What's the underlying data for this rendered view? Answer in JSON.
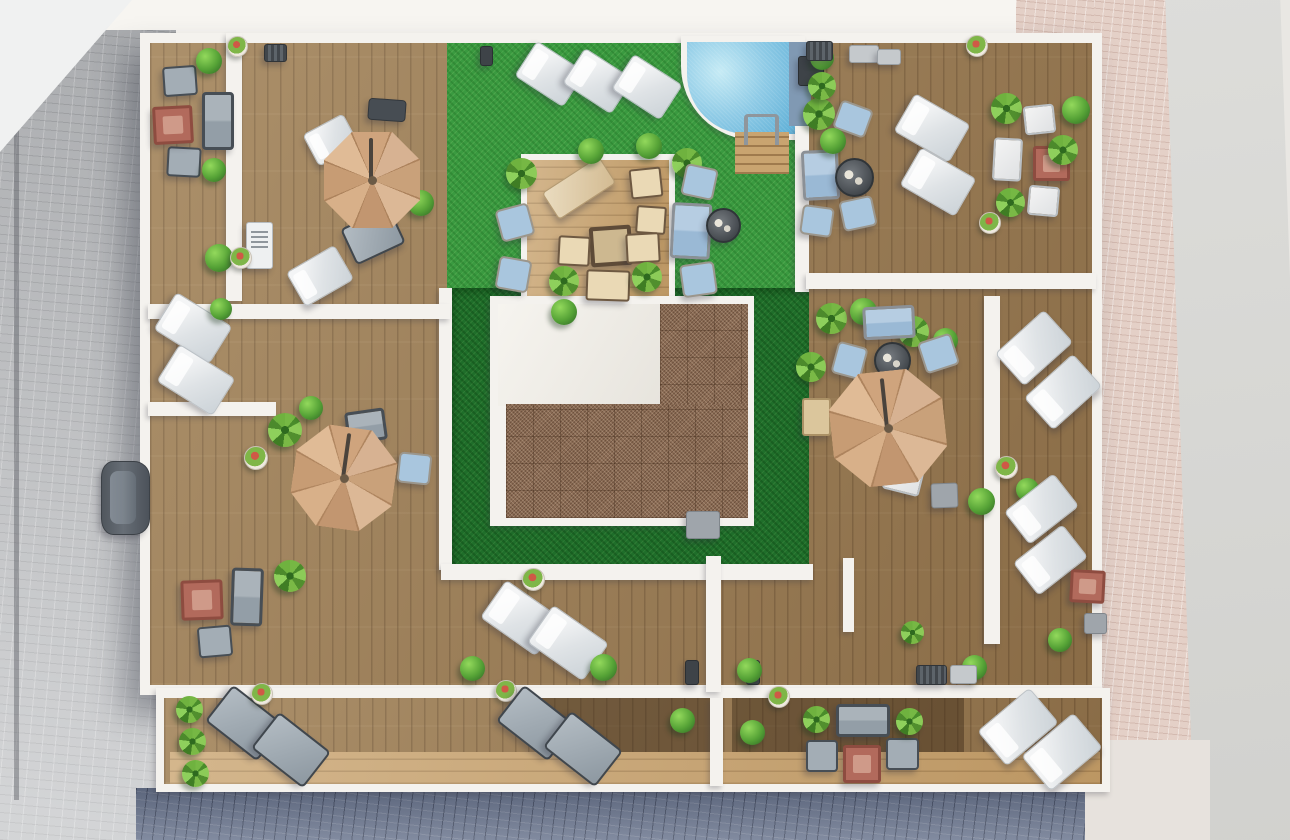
{
  "meta": {
    "description": "Photorealistic aerial 3D render of an apartment-building rooftop terrace plan: perimeter wooden sun decks divided by white parapet walls, central artificial-grass garden with a quarter-round swimming pool, timber pergola lounge platform, gravel-covered central core roof, three tan cantilever parasols, sun loungers, sofa sets and planting; surrounding streets with cobble paving and one parked car.",
    "width_px": 1290,
    "height_px": 840,
    "visible_text": []
  },
  "palette": {
    "deck_wood": "#9c7d54",
    "deck_light_wood": "#c9a470",
    "lawn_bright": "#3a9a40",
    "lawn_dark": "#1f6e2a",
    "gravel_roof": "#8b6c55",
    "pool_water": "#8fcbe6",
    "parasol_tan": "#cfa47d",
    "white_wall": "#f4f2ee",
    "street_grey": "#b4b6b9",
    "street_pink": "#e4d0c7",
    "street_blue_grey": "#6d7890",
    "road_light": "#d9d9d6"
  },
  "legend": {
    "lounger-w": "sun-lounger-white",
    "lounger-g": "sun-lounger-grey",
    "lounger-dark": "bench-dark",
    "lounger-beige": "sun-lounger-beige",
    "sofa-grey": "outdoor-sofa-grey",
    "sofa-blue": "outdoor-sofa-blue",
    "armchair-grey": "armchair-grey",
    "armchair-blue": "armchair-blue",
    "armchair-w": "armchair-white",
    "seat-white": "seat-white",
    "seat-beige": "seat-beige",
    "table-red": "coffee-table-terracotta",
    "table-beige": "side-table-beige",
    "table-round": "round-table-dark",
    "table-dark-beige": "dining-table-wood",
    "cube-grey": "utility-box-grey",
    "cube-dark": "planter-dark",
    "vent-dark": "ac-vent-dark",
    "vent-grey": "ac-unit-grey",
    "bbq": "outdoor-kitchen-grill",
    "pot": "flower-pot",
    "bush": "shrub-plant",
    "palm": "palm-plant",
    "umbrella": "parasol-umbrella",
    "car": "parked-car",
    "ladder": "pool-ladder"
  },
  "layer_fields": [
    "name",
    "class",
    "x",
    "y",
    "w",
    "h",
    "rotation_deg",
    "border_radius"
  ],
  "layers": [
    [
      "base-ground",
      "base",
      0,
      0,
      1290,
      840,
      0,
      ""
    ],
    [
      "sky-band-top",
      "band",
      0,
      0,
      1048,
      36,
      0,
      ""
    ],
    [
      "pink-paving-top",
      "pave-pink",
      1016,
      0,
      100,
      36,
      0,
      ""
    ],
    [
      "street-left",
      "pave-grey",
      0,
      30,
      176,
      810,
      0,
      ""
    ],
    [
      "street-left-curb",
      "curb",
      14,
      30,
      5,
      770,
      0,
      ""
    ],
    [
      "street-corner-top-left",
      "wedge",
      0,
      0,
      132,
      152,
      0,
      ""
    ],
    [
      "street-right-pink",
      "pave-pink",
      1094,
      0,
      106,
      818,
      0,
      ""
    ],
    [
      "road-right",
      "road",
      1180,
      -20,
      115,
      885,
      -2,
      ""
    ],
    [
      "street-bottom",
      "pave-blue",
      136,
      788,
      968,
      52,
      0,
      ""
    ],
    [
      "street-corner-bottom-right",
      "pave-light",
      1085,
      740,
      125,
      100,
      0,
      ""
    ],
    [
      "building-parapet",
      "bldg",
      140,
      33,
      962,
      662,
      0,
      ""
    ],
    [
      "main-deck",
      "deck-wood",
      150,
      43,
      942,
      642,
      0,
      ""
    ],
    [
      "lower-terrace-wall",
      "wall",
      156,
      688,
      954,
      104,
      0,
      ""
    ],
    [
      "lower-terrace-deck",
      "deck-wood",
      164,
      698,
      938,
      86,
      0,
      ""
    ],
    [
      "lower-terrace-light-band",
      "deck-light",
      170,
      752,
      930,
      32,
      0,
      ""
    ],
    [
      "lower-terrace-dark-a",
      "deck-dark",
      540,
      698,
      176,
      54,
      0,
      ""
    ],
    [
      "lower-terrace-dark-b",
      "deck-dark",
      732,
      698,
      232,
      54,
      0,
      ""
    ],
    [
      "lawn-bright",
      "lawn",
      447,
      43,
      360,
      248,
      0,
      ""
    ],
    [
      "lawn-dark-ring",
      "lawn-dark",
      451,
      288,
      358,
      280,
      0,
      ""
    ],
    [
      "wall-lawn-left",
      "wall",
      439,
      288,
      13,
      282,
      0,
      ""
    ],
    [
      "wall-lawn-bottom",
      "wall",
      441,
      564,
      372,
      16,
      0,
      ""
    ],
    [
      "pool-coping",
      "wall",
      681,
      36,
      124,
      104,
      0,
      "0 0 0 74px"
    ],
    [
      "pool-water",
      "pool",
      687,
      42,
      112,
      92,
      0,
      "0 0 0 60px"
    ],
    [
      "pool-side-deck",
      "pool-side",
      789,
      42,
      22,
      84,
      0,
      "0 0 6px 0"
    ],
    [
      "pool-steps",
      "steps",
      735,
      132,
      54,
      42,
      0,
      ""
    ],
    [
      "pergola-coping",
      "wall",
      521,
      154,
      154,
      152,
      0,
      ""
    ],
    [
      "pergola-deck",
      "deck-light",
      527,
      160,
      142,
      140,
      0,
      ""
    ],
    [
      "core-parapet",
      "wall",
      490,
      296,
      264,
      230,
      0,
      ""
    ],
    [
      "core-roof-white",
      "roof-white",
      498,
      304,
      162,
      102,
      0,
      ""
    ],
    [
      "core-gravel-upper",
      "gravel",
      660,
      304,
      88,
      108,
      0,
      ""
    ],
    [
      "core-gravel-lower",
      "gravel",
      506,
      404,
      242,
      114,
      0,
      ""
    ],
    [
      "divider-wall-1",
      "wall",
      226,
      33,
      16,
      268,
      0,
      ""
    ],
    [
      "divider-wall-2",
      "wall",
      148,
      304,
      302,
      15,
      0,
      ""
    ],
    [
      "divider-wall-3",
      "wall",
      148,
      402,
      128,
      14,
      0,
      ""
    ],
    [
      "divider-wall-4",
      "wall",
      795,
      126,
      14,
      166,
      0,
      ""
    ],
    [
      "divider-wall-5",
      "wall",
      806,
      273,
      290,
      16,
      0,
      ""
    ],
    [
      "divider-wall-6",
      "wall",
      984,
      296,
      16,
      348,
      0,
      ""
    ],
    [
      "divider-wall-7",
      "wall",
      706,
      556,
      15,
      136,
      0,
      ""
    ],
    [
      "divider-wall-8",
      "wall",
      710,
      698,
      13,
      88,
      0,
      ""
    ],
    [
      "divider-wall-9",
      "wall",
      843,
      558,
      11,
      74,
      0,
      ""
    ]
  ],
  "item_fields": [
    "type",
    "x",
    "y",
    "w",
    "h",
    "rotation_deg"
  ],
  "items": [
    [
      "armchair-grey",
      163,
      66,
      30,
      26,
      -4
    ],
    [
      "sofa-grey",
      202,
      92,
      26,
      52,
      0
    ],
    [
      "armchair-grey",
      167,
      147,
      30,
      26,
      3
    ],
    [
      "table-red",
      153,
      106,
      34,
      32,
      -3
    ],
    [
      "bush",
      196,
      48,
      26,
      26,
      0
    ],
    [
      "bush",
      202,
      158,
      24,
      24,
      0
    ],
    [
      "bush",
      205,
      244,
      28,
      28,
      0
    ],
    [
      "vent-dark",
      264,
      44,
      21,
      16,
      0
    ],
    [
      "bbq",
      246,
      222,
      25,
      45,
      0
    ],
    [
      "pot",
      227,
      36,
      19,
      19,
      0
    ],
    [
      "pot",
      230,
      247,
      20,
      20,
      0
    ],
    [
      "lounger-dark",
      368,
      99,
      36,
      20,
      4
    ],
    [
      "lounger-w",
      308,
      122,
      44,
      34,
      -28
    ],
    [
      "lounger-g",
      346,
      216,
      50,
      36,
      -25
    ],
    [
      "lounger-w",
      292,
      256,
      54,
      38,
      -30
    ],
    [
      "bush",
      408,
      190,
      26,
      26,
      0
    ],
    [
      "lounger-w",
      160,
      306,
      64,
      42,
      32
    ],
    [
      "lounger-w",
      163,
      358,
      64,
      42,
      32
    ],
    [
      "bush",
      210,
      298,
      22,
      22,
      0
    ],
    [
      "palm",
      268,
      413,
      34,
      34,
      0
    ],
    [
      "bush",
      299,
      396,
      24,
      24,
      0
    ],
    [
      "sofa-grey",
      346,
      410,
      34,
      26,
      -8
    ],
    [
      "armchair-blue",
      398,
      453,
      29,
      27,
      6
    ],
    [
      "pot",
      244,
      446,
      22,
      22,
      0
    ],
    [
      "palm",
      274,
      560,
      32,
      32,
      0
    ],
    [
      "table-red",
      181,
      580,
      36,
      34,
      -2
    ],
    [
      "sofa-grey",
      231,
      568,
      26,
      52,
      2
    ],
    [
      "armchair-grey",
      198,
      626,
      30,
      27,
      -5
    ],
    [
      "car",
      101,
      461,
      47,
      72,
      0
    ],
    [
      "palm",
      176,
      696,
      27,
      27,
      0
    ],
    [
      "palm",
      179,
      728,
      27,
      27,
      0
    ],
    [
      "palm",
      182,
      760,
      27,
      27,
      0
    ],
    [
      "lounger-g",
      212,
      700,
      62,
      42,
      38
    ],
    [
      "lounger-g",
      258,
      727,
      62,
      42,
      38
    ],
    [
      "pot",
      251,
      683,
      20,
      20,
      0
    ],
    [
      "pot",
      495,
      680,
      20,
      20,
      0
    ],
    [
      "lounger-g",
      503,
      700,
      62,
      42,
      38
    ],
    [
      "lounger-g",
      550,
      726,
      62,
      42,
      38
    ],
    [
      "bush",
      670,
      708,
      25,
      25,
      0
    ],
    [
      "bush",
      740,
      720,
      25,
      25,
      0
    ],
    [
      "pot",
      768,
      686,
      20,
      20,
      0
    ],
    [
      "sofa-grey",
      836,
      704,
      48,
      27,
      0
    ],
    [
      "armchair-grey",
      806,
      740,
      28,
      28,
      0
    ],
    [
      "armchair-grey",
      886,
      738,
      29,
      28,
      0
    ],
    [
      "table-red",
      843,
      745,
      32,
      32,
      0
    ],
    [
      "palm",
      803,
      706,
      27,
      27,
      0
    ],
    [
      "palm",
      896,
      708,
      27,
      27,
      0
    ],
    [
      "lounger-w",
      984,
      704,
      66,
      44,
      -40
    ],
    [
      "lounger-w",
      1028,
      729,
      66,
      44,
      -40
    ],
    [
      "lounger-w",
      487,
      595,
      66,
      44,
      35
    ],
    [
      "lounger-w",
      534,
      620,
      66,
      44,
      35
    ],
    [
      "bush",
      460,
      656,
      25,
      25,
      0
    ],
    [
      "bush",
      590,
      654,
      27,
      27,
      0
    ],
    [
      "pot",
      522,
      568,
      21,
      21,
      0
    ],
    [
      "cube-dark",
      685,
      660,
      12,
      23,
      0
    ],
    [
      "cube-dark",
      746,
      660,
      12,
      23,
      0
    ],
    [
      "bush",
      737,
      658,
      25,
      25,
      0
    ],
    [
      "palm",
      901,
      621,
      23,
      23,
      0
    ],
    [
      "bush",
      962,
      655,
      25,
      25,
      0
    ],
    [
      "vent-dark",
      916,
      665,
      29,
      18,
      0
    ],
    [
      "vent-grey",
      950,
      665,
      25,
      17,
      0
    ],
    [
      "bush",
      1048,
      628,
      24,
      24,
      0
    ],
    [
      "lounger-w",
      521,
      53,
      56,
      40,
      33
    ],
    [
      "lounger-w",
      569,
      60,
      56,
      40,
      33
    ],
    [
      "lounger-w",
      618,
      66,
      56,
      40,
      33
    ],
    [
      "cube-dark",
      480,
      46,
      11,
      18,
      0
    ],
    [
      "lounger-beige",
      545,
      172,
      66,
      30,
      -33
    ],
    [
      "seat-beige",
      630,
      168,
      28,
      26,
      -6
    ],
    [
      "seat-beige",
      636,
      206,
      26,
      24,
      4
    ],
    [
      "table-dark-beige",
      590,
      226,
      34,
      32,
      -4
    ],
    [
      "seat-beige",
      558,
      236,
      28,
      26,
      3
    ],
    [
      "seat-beige",
      626,
      233,
      30,
      26,
      -3
    ],
    [
      "seat-beige",
      586,
      270,
      40,
      27,
      2
    ],
    [
      "palm",
      549,
      266,
      30,
      30,
      0
    ],
    [
      "palm",
      632,
      262,
      30,
      30,
      0
    ],
    [
      "palm",
      506,
      158,
      31,
      31,
      0
    ],
    [
      "palm",
      672,
      148,
      30,
      30,
      0
    ],
    [
      "bush",
      578,
      138,
      26,
      26,
      0
    ],
    [
      "bush",
      636,
      133,
      26,
      26,
      0
    ],
    [
      "armchair-blue",
      498,
      206,
      30,
      29,
      -15
    ],
    [
      "armchair-blue",
      497,
      258,
      29,
      29,
      10
    ],
    [
      "armchair-blue",
      683,
      166,
      29,
      28,
      12
    ],
    [
      "sofa-blue",
      671,
      203,
      34,
      50,
      3
    ],
    [
      "armchair-blue",
      681,
      263,
      31,
      29,
      -8
    ],
    [
      "table-round",
      706,
      208,
      31,
      31,
      0
    ],
    [
      "bush",
      551,
      299,
      26,
      26,
      0
    ],
    [
      "ladder",
      744,
      114,
      27,
      28,
      0
    ],
    [
      "cube-dark",
      798,
      56,
      24,
      28,
      0
    ],
    [
      "armchair-blue",
      836,
      104,
      30,
      26,
      20
    ],
    [
      "sofa-blue",
      802,
      150,
      31,
      44,
      -3
    ],
    [
      "table-round",
      835,
      158,
      35,
      35,
      0
    ],
    [
      "armchair-blue",
      841,
      198,
      30,
      27,
      -12
    ],
    [
      "armchair-blue",
      801,
      206,
      28,
      26,
      8
    ],
    [
      "palm",
      803,
      98,
      32,
      32,
      0
    ],
    [
      "bush",
      820,
      128,
      26,
      26,
      0
    ],
    [
      "bush",
      810,
      46,
      24,
      24,
      0
    ],
    [
      "palm",
      808,
      72,
      28,
      28,
      0
    ],
    [
      "lounger-w",
      900,
      106,
      62,
      42,
      30
    ],
    [
      "lounger-w",
      906,
      160,
      62,
      42,
      30
    ],
    [
      "palm",
      991,
      93,
      31,
      31,
      0
    ],
    [
      "armchair-w",
      1024,
      105,
      27,
      25,
      -6
    ],
    [
      "seat-white",
      993,
      138,
      25,
      39,
      3
    ],
    [
      "table-red",
      1033,
      146,
      31,
      29,
      0
    ],
    [
      "armchair-w",
      1028,
      186,
      27,
      26,
      5
    ],
    [
      "palm",
      996,
      188,
      29,
      29,
      0
    ],
    [
      "pot",
      966,
      35,
      20,
      20,
      0
    ],
    [
      "pot",
      979,
      212,
      20,
      20,
      0
    ],
    [
      "vent-dark",
      806,
      41,
      25,
      18,
      0
    ],
    [
      "vent-grey",
      849,
      45,
      28,
      16,
      0
    ],
    [
      "vent-grey",
      877,
      49,
      22,
      14,
      0
    ],
    [
      "bush",
      1062,
      96,
      28,
      28,
      0
    ],
    [
      "palm",
      1048,
      135,
      30,
      30,
      0
    ],
    [
      "palm",
      816,
      303,
      31,
      31,
      0
    ],
    [
      "bush",
      850,
      298,
      27,
      27,
      0
    ],
    [
      "palm",
      898,
      316,
      31,
      31,
      0
    ],
    [
      "bush",
      933,
      328,
      25,
      25,
      0
    ],
    [
      "sofa-blue",
      863,
      306,
      46,
      27,
      -3
    ],
    [
      "table-round",
      874,
      342,
      33,
      33,
      0
    ],
    [
      "armchair-blue",
      834,
      344,
      27,
      29,
      15
    ],
    [
      "armchair-blue",
      921,
      337,
      31,
      29,
      -18
    ],
    [
      "seat-white",
      884,
      466,
      34,
      23,
      14
    ],
    [
      "cube-grey",
      931,
      483,
      25,
      23,
      -2
    ],
    [
      "table-beige",
      802,
      398,
      25,
      34,
      0
    ],
    [
      "palm",
      796,
      352,
      30,
      30,
      0
    ],
    [
      "bush",
      968,
      488,
      27,
      27,
      0
    ],
    [
      "bush",
      1016,
      478,
      23,
      23,
      0
    ],
    [
      "pot",
      995,
      456,
      21,
      21,
      0
    ],
    [
      "lounger-w",
      1001,
      326,
      64,
      42,
      -42
    ],
    [
      "lounger-w",
      1030,
      370,
      64,
      42,
      -42
    ],
    [
      "lounger-w",
      1010,
      488,
      61,
      40,
      -38
    ],
    [
      "lounger-w",
      1019,
      539,
      61,
      40,
      -38
    ],
    [
      "table-red",
      1070,
      570,
      29,
      27,
      3
    ],
    [
      "cube-grey",
      1084,
      613,
      21,
      19,
      0
    ],
    [
      "cube-grey",
      686,
      511,
      32,
      26,
      0
    ],
    [
      "umbrella",
      324,
      132,
      96,
      96,
      0
    ],
    [
      "umbrella",
      293,
      427,
      102,
      102,
      8
    ],
    [
      "umbrella",
      831,
      371,
      114,
      114,
      -6
    ]
  ]
}
